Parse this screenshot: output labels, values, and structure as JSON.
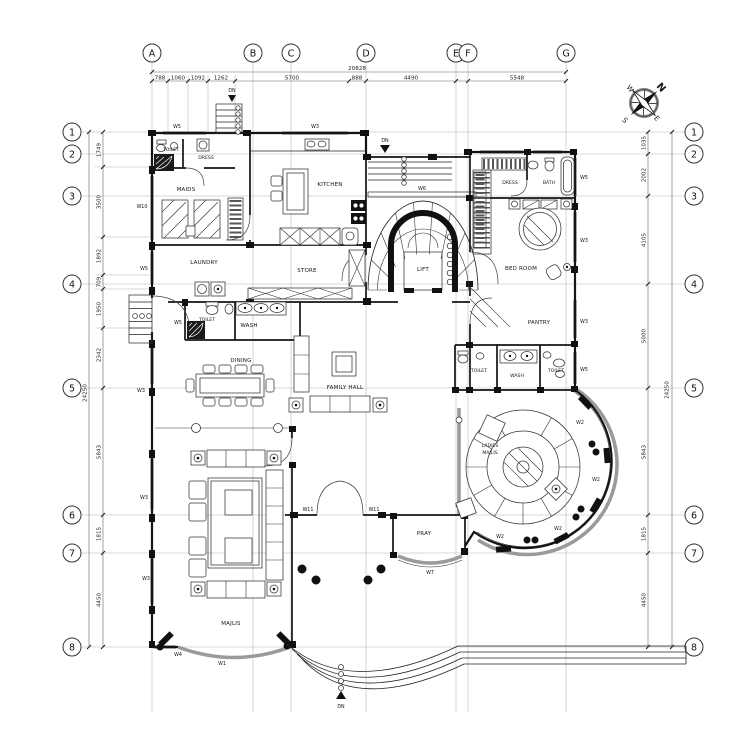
{
  "compass": {
    "n": "N",
    "w": "W",
    "s": "S",
    "e": "E"
  },
  "columns": [
    {
      "label": "A"
    },
    {
      "label": "B"
    },
    {
      "label": "C"
    },
    {
      "label": "D"
    },
    {
      "label": "E"
    },
    {
      "label": "F"
    },
    {
      "label": "G"
    }
  ],
  "rows": [
    {
      "label": "1"
    },
    {
      "label": "2"
    },
    {
      "label": "3"
    },
    {
      "label": "4"
    },
    {
      "label": "5"
    },
    {
      "label": "6"
    },
    {
      "label": "7"
    },
    {
      "label": "8"
    }
  ],
  "dims": {
    "top_total": "20828",
    "top": [
      "788",
      "1060",
      "1092",
      "1262",
      "5700",
      "888",
      "4490",
      "5548"
    ],
    "left": [
      "1749",
      "3500",
      "1892",
      "709",
      "1950",
      "2342",
      "5843",
      "1815",
      "4450"
    ],
    "left_total": "24250",
    "right": [
      "1035",
      "2002",
      "4105",
      "5000",
      "5843",
      "1815",
      "4450"
    ],
    "right_total": "24250"
  },
  "rooms": {
    "toilet_maids": "TOILET",
    "dress_maids": "DRESS",
    "maids": "MAIDS",
    "kitchen": "KITCHEN",
    "laundry": "LAUNDRY",
    "store": "STORE",
    "toilet_left": "TOILET",
    "wash_left": "WASH",
    "dining": "DINING",
    "family_hall": "FAMILY HALL",
    "lift": "LIFT",
    "dress_master": "DRESS",
    "bath": "BATH",
    "bedroom": "BED ROOM",
    "pantry": "PANTRY",
    "toilet_r1": "TOILET",
    "wash_right": "WASH",
    "toilet_r2": "TOILET",
    "ladies_line1": "LADIES",
    "ladies_line2": "MAJLIS",
    "pray": "PRAY",
    "majlis": "MAJLIS"
  },
  "tags": {
    "w1": "W1",
    "w2": "W2",
    "w3": "W3",
    "w4": "W4",
    "w5": "W5",
    "w6": "W6",
    "w7": "W7",
    "w10": "W10",
    "w11": "W11"
  },
  "stairs": {
    "dn": "DN"
  }
}
